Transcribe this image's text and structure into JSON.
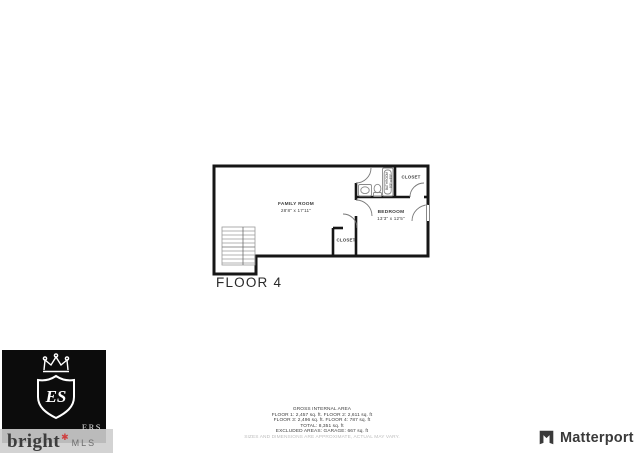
{
  "floor_plan": {
    "caption": "FLOOR 4",
    "rooms": {
      "family_room": {
        "name": "FAMILY ROOM",
        "dims": "28'8\" x 17'11\""
      },
      "bedroom": {
        "name": "BEDROOM",
        "dims": "13'3\" x 12'5\""
      },
      "closet_top": {
        "label": "CLOSET"
      },
      "closet_bottom": {
        "label": "CLOSET"
      },
      "bathroom": {
        "name": "BATHROOM",
        "dims": "5'2\" x 8'5\""
      }
    }
  },
  "area_summary": {
    "title": "GROSS INTERNAL AREA",
    "lines": [
      "FLOOR 1: 2,457 sq. ft. FLOOR 2: 2,611 sq. ft",
      "FLOOR 3: 2,496 sq. ft. FLOOR 4: 787 sq. ft",
      "TOTAL: 8,351 sq. ft",
      "EXCLUDED AREAS: GARAGE: 667 sq. ft"
    ],
    "disclaimer": "SIZES AND DIMENSIONS ARE APPROXIMATE, ACTUAL MAY VARY."
  },
  "branding": {
    "agency": {
      "monogram": "ES",
      "text_fragment": "ERS"
    },
    "watermark": {
      "word": "bright",
      "suffix": "MLS",
      "star": "✱"
    },
    "matterport": {
      "label": "Matterport"
    }
  }
}
